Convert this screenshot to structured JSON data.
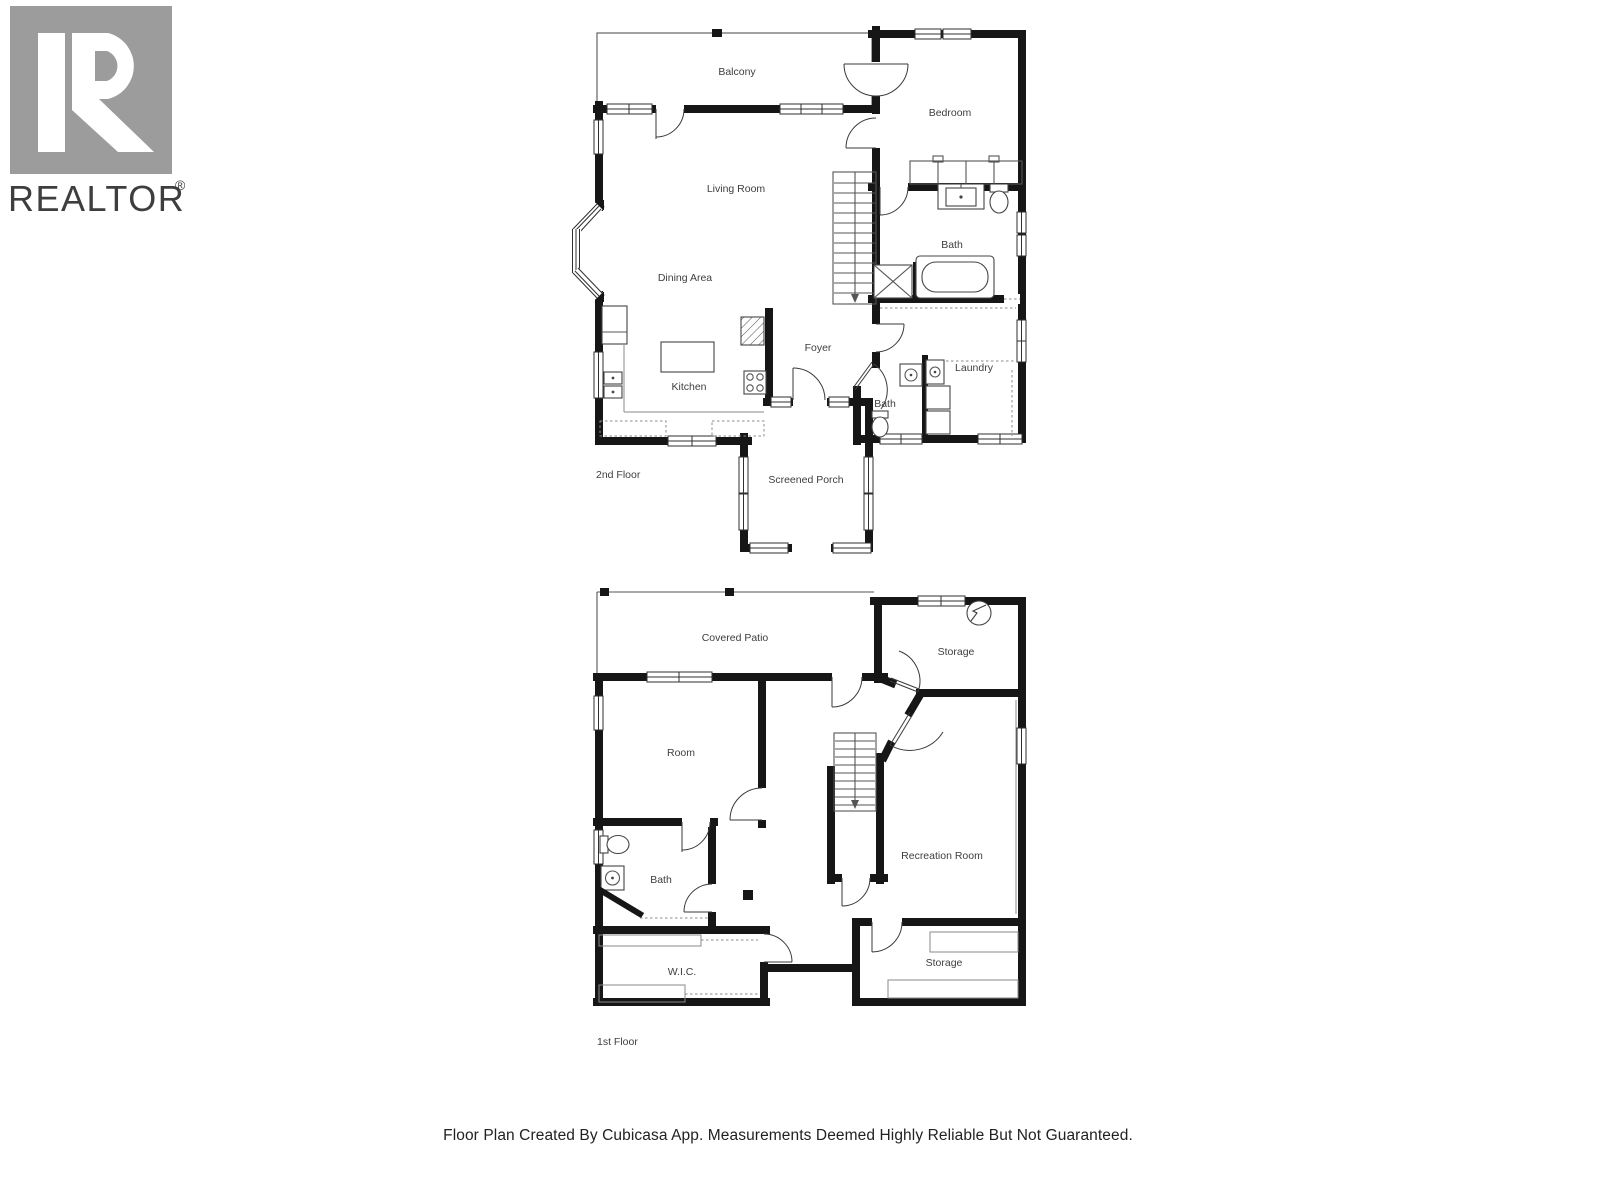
{
  "branding": {
    "logo_text": "REALTOR",
    "registered": "®"
  },
  "floors": [
    {
      "title": "2nd Floor",
      "rooms": [
        "Balcony",
        "Bedroom",
        "Living Room",
        "Dining Area",
        "Bath",
        "Foyer",
        "Kitchen",
        "Laundry",
        "Bath",
        "Screened Porch"
      ]
    },
    {
      "title": "1st Floor",
      "rooms": [
        "Covered Patio",
        "Storage",
        "Room",
        "Recreation Room",
        "Bath",
        "W.I.C.",
        "Storage"
      ]
    }
  ],
  "footer": {
    "disclaimer": "Floor Plan Created By Cubicasa App. Measurements Deemed Highly Reliable But Not Guaranteed."
  },
  "colors": {
    "wall": "#161616",
    "label": "#3e3e3e",
    "logo_gray": "#9c9c9c",
    "background": "#ffffff"
  }
}
